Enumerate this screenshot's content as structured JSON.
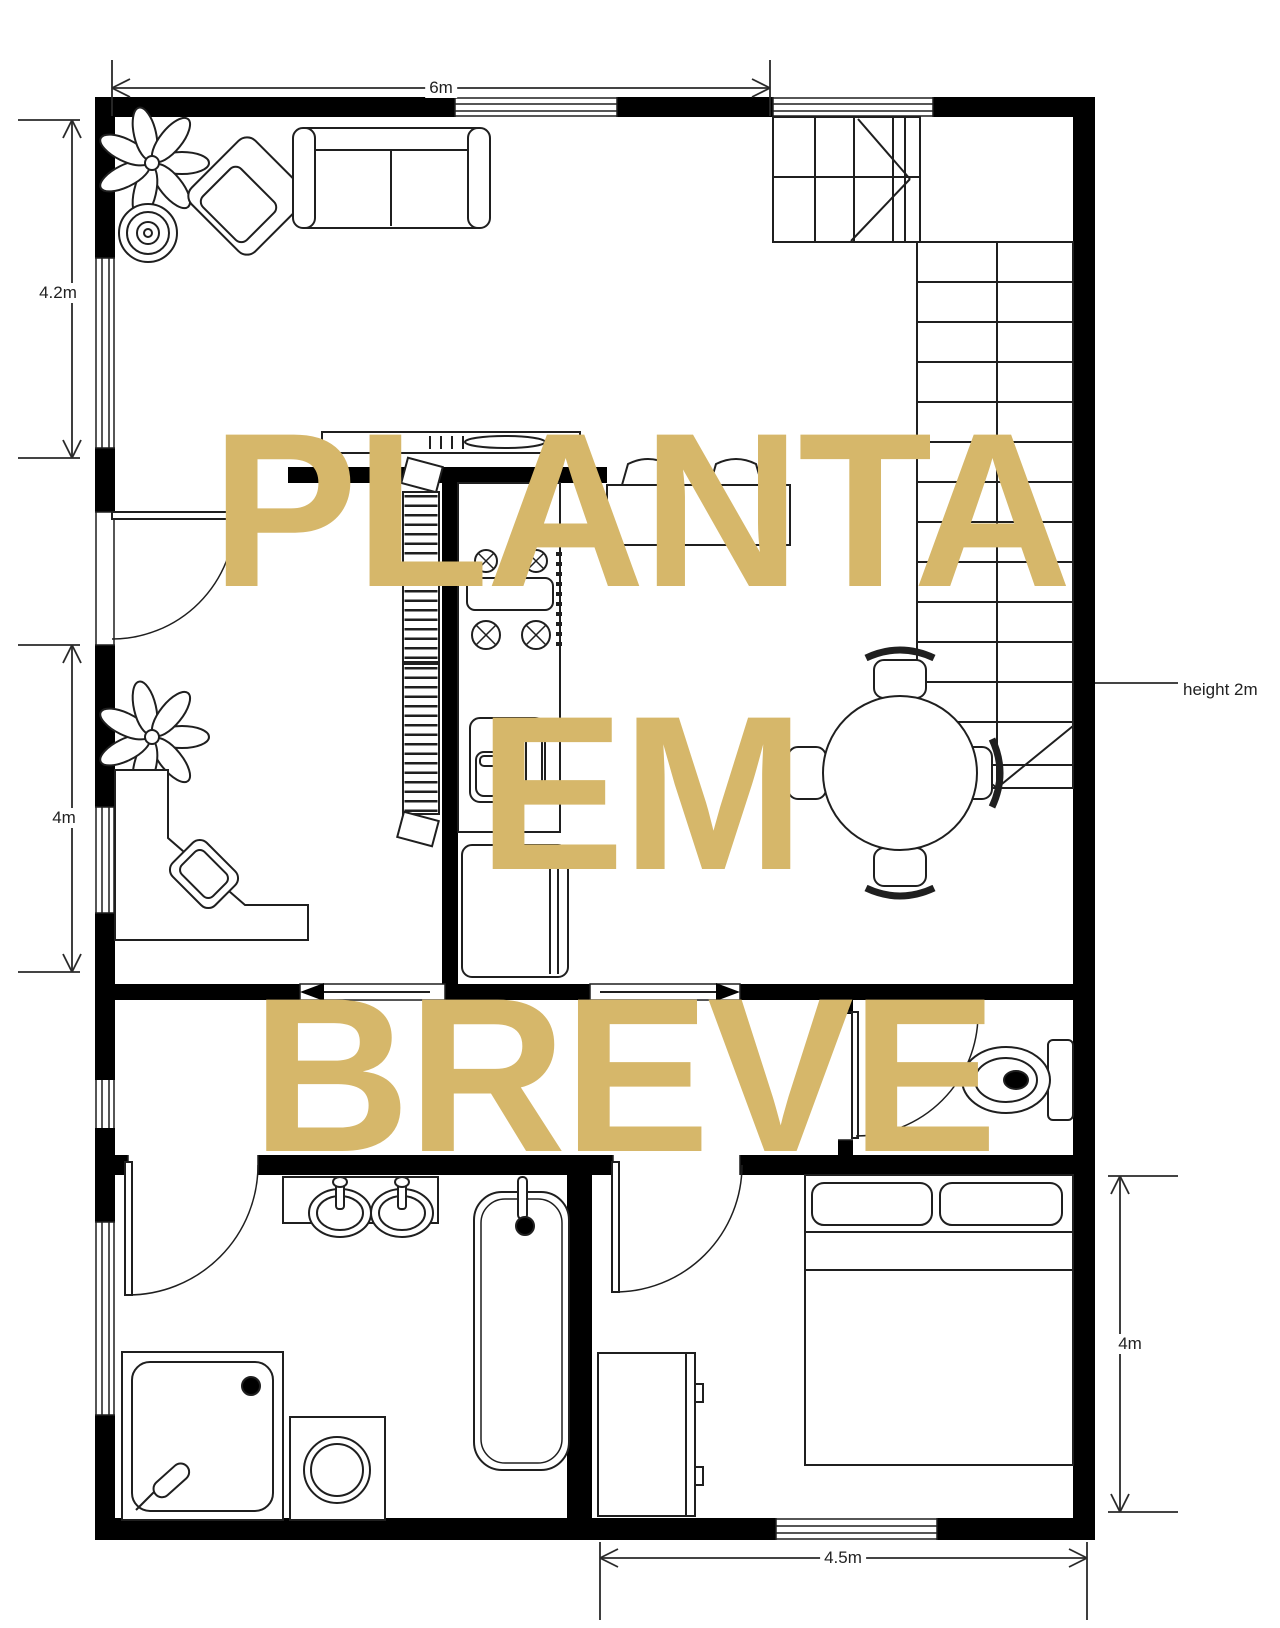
{
  "watermark": {
    "line1": "PLANTA",
    "line2": "EM",
    "line3": "BREVE",
    "color": "#d6b76a"
  },
  "dimensions": {
    "top_width": "6m",
    "left_upper_height": "4.2m",
    "left_lower_height": "4m",
    "right_height": "4m",
    "bottom_width": "4.5m",
    "stair_note": "height 2m"
  },
  "colors": {
    "wall": "#000000",
    "line": "#1f1f1f",
    "dimension": "#2a2a2a",
    "background": "#ffffff"
  }
}
